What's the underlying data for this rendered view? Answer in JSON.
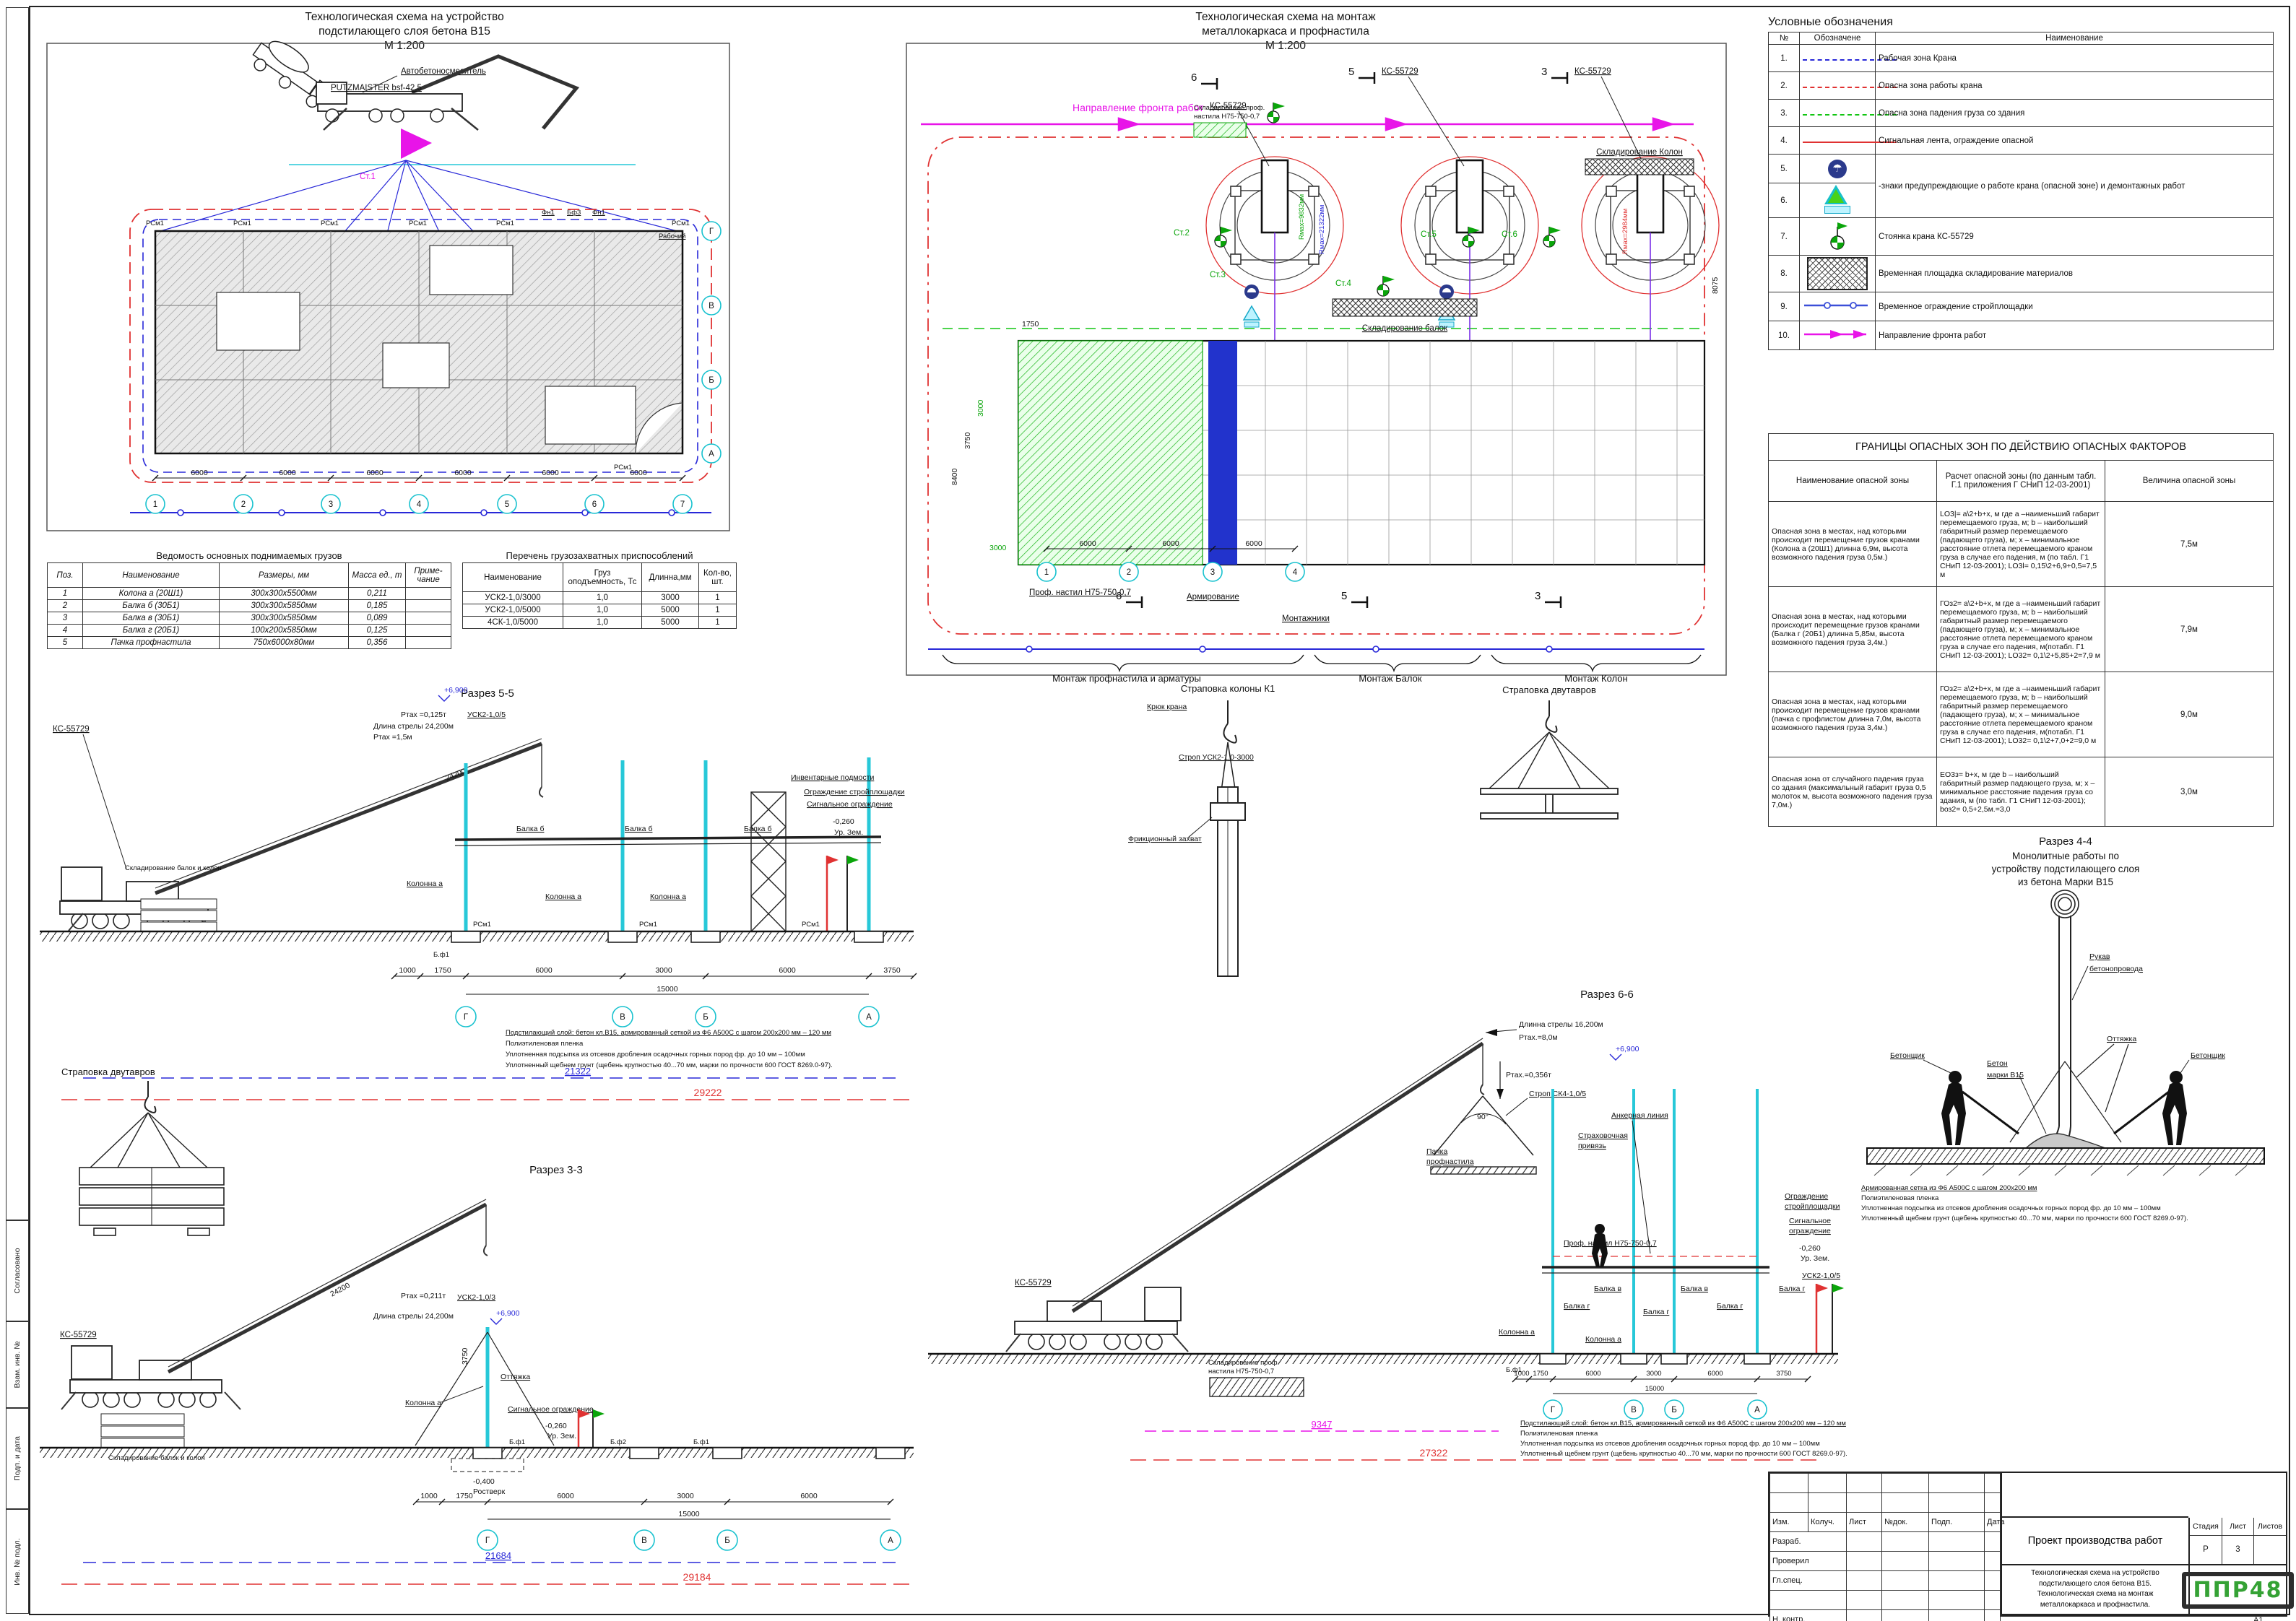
{
  "titles": {
    "plan1_l1": "Технологическая схема на устройство",
    "plan1_l2": "подстилающего слоя бетона В15",
    "plan1_scale": "М 1:200",
    "plan2_l1": "Технологическая схема на монтаж",
    "plan2_l2": "металлокаркаса и профнастила",
    "plan2_scale": "М 1:200"
  },
  "frame": {
    "fields": [
      "Согласовано",
      "Взам. инв. №",
      "Подп. и дата",
      "Инв. № подл."
    ],
    "format": "А1"
  },
  "legend": {
    "title": "Условные обозначения",
    "h_num": "№",
    "h_sym": "Обозначене",
    "h_name": "Наименование",
    "rows": [
      {
        "n": "1.",
        "name": "Рабочая зона Крана"
      },
      {
        "n": "2.",
        "name": "Опасна зона работы крана"
      },
      {
        "n": "3.",
        "name": "Опасна зона падения груза со здания"
      },
      {
        "n": "4.",
        "name": "Сигнальная лента, ограждение опасной"
      },
      {
        "n": "5.",
        "name": ""
      },
      {
        "n": "6.",
        "name": "-знаки предупреждающие о работе крана (опасной зоне) и демонтажных работ"
      },
      {
        "n": "7.",
        "name": "Стоянка крана КС-55729"
      },
      {
        "n": "8.",
        "name": "Временная площадка складирование материалов"
      },
      {
        "n": "9.",
        "name": "Временное ограждение стройплощадки"
      },
      {
        "n": "10.",
        "name": "Направление фронта работ"
      }
    ]
  },
  "danger": {
    "title": "ГРАНИЦЫ ОПАСНЫХ ЗОН ПО ДЕЙСТВИЮ ОПАСНЫХ ФАКТОРОВ",
    "h1": "Наименование опасной зоны",
    "h2": "Расчет опасной зоны (по данным табл. Г.1 приложения Г СНиП 12-03-2001)",
    "h3": "Величина опасной зоны",
    "rows": [
      {
        "name": "Опасная зона в местах, над которыми происходит перемещение грузов кранами (Колона а (20Ш1) длинна 6,9м, высота возможного падения груза 0,5м.)",
        "calc": "LO3|= a\\2+b+x, м  где а –наименьший габарит перемещаемого груза, м; b – наибольший габаритный размер перемещаемого (падающего груза), м; x – минимальное расстояние отлета перемещаемого краном груза в случае его падения, м (по табл. Г1 СНиП 12-03-2001); LO3l= 0,15\\2+6,9+0,5=7,5 м",
        "val": "7,5м"
      },
      {
        "name": "Опасная зона в местах, над которыми происходит перемещение грузов кранами (Балка г (20Б1) длинна 5,85м, высота возможного падения груза 3,4м.)",
        "calc": "ГОз2= a\\2+b+x, м  где а –наименьший габарит перемещаемого груза, м; b – наибольший габаритный размер перемещаемого (падающего груза), м; x – минимальное расстояние отлета перемещаемого краном груза в случае его падения, м(потабл. Г1 СНиП 12-03-2001); LO32= 0,1\\2+5,85+2=7,9 м",
        "val": "7,9м"
      },
      {
        "name": "Опасная зона в местах, над которыми происходит перемещение грузов кранами (пачка с профлистом длинна 7,0м, высота возможного падения груза 3,4м.)",
        "calc": "ГОз2= a\\2+b+x, м  где а –наименьший габарит перемещаемого груза, м; b – наибольший габаритный размер перемещаемого (падающего груза), м; x – минимальное расстояние отлета перемещаемого краном груза в случае его падения, м(потабл. Г1 СНиП 12-03-2001); LO32= 0,1\\2+7,0+2=9,0 м",
        "val": "9,0м"
      },
      {
        "name": "Опасная зона от случайного падения груза со здания (максимальный габарит груза 0,5 молоток м, высота возможного падения груза 7,0м.)",
        "calc": "EO3з= b+x, м  где b – наибольший габаритный размер падающего груза, м; x – минимальное расстояние падения груза со здания, м (по табл. Г1 СНиП 12-03-2001); bоз2= 0,5+2,5м.=3,0",
        "val": "3,0м"
      }
    ]
  },
  "loads": {
    "title": "Ведомость основных поднимаемых грузов",
    "headers": [
      "Поз.",
      "Наименование",
      "Размеры, мм",
      "Масса ед., т",
      "Приме- чание"
    ],
    "rows": [
      [
        "1",
        "Колона а (20Ш1)",
        "300х300х5500мм",
        "0,211",
        ""
      ],
      [
        "2",
        "Балка б (30Б1)",
        "300х300х5850мм",
        "0,185",
        ""
      ],
      [
        "3",
        "Балка в (30Б1)",
        "300х300х5850мм",
        "0,089",
        ""
      ],
      [
        "4",
        "Балка г (20Б1)",
        "100х200х5850мм",
        "0,125",
        ""
      ],
      [
        "5",
        "Пачка профнастила",
        "750х6000х80мм",
        "0,356",
        ""
      ]
    ]
  },
  "slings": {
    "title": "Перечень грузозахватных приспособлений",
    "headers": [
      "Наименование",
      "Груз оподъемность, Тс",
      "Длинна,мм",
      "Кол-во, шт."
    ],
    "rows": [
      [
        "УСК2-1,0/3000",
        "1,0",
        "3000",
        "1"
      ],
      [
        "УСК2-1,0/5000",
        "1,0",
        "5000",
        "1"
      ],
      [
        "4СК-1,0/5000",
        "1,0",
        "5000",
        "1"
      ]
    ]
  },
  "plan1": {
    "mixer": "Автобетоносмеситель",
    "pump": "PUTZMAISTER bsf-42,5",
    "stand": "Ст.1",
    "worker": "Рабочий",
    "rcm": "РСм1",
    "fn1": "Фн1",
    "bf3": "Бф3",
    "dim": "6000",
    "axes_num": [
      "1",
      "2",
      "3",
      "4",
      "5",
      "6",
      "7"
    ],
    "axes_let": [
      "Г",
      "В",
      "Б",
      "А"
    ]
  },
  "plan2": {
    "direction": "Направление фронта работ",
    "crane": "КС-55729",
    "stands": [
      "Ст.1",
      "Ст.2",
      "Ст.3",
      "Ст.4",
      "Ст.5",
      "Ст.6"
    ],
    "skl_prof1": "Складирование проф.",
    "skl_prof2": "настила Н75-750-0,7",
    "skl_balok": "Складирование балок",
    "skl_kolon": "Складирование Колон",
    "prof_nastil": "Проф. настил Н75-750-0,7",
    "armir": "Армирование",
    "mont": "Монтажники",
    "brace1": "Монтаж профнастила и арматуры",
    "brace2": "Монтаж Балок",
    "brace3": "Монтаж Колон",
    "r_green": "Rмах=9832мм",
    "r_blue": "Rмах=21322мм",
    "r_red": "Rмах=2984мм",
    "d6000": "6000",
    "d3000": "3000",
    "d3750": "3750",
    "d1750": "1750",
    "d8075": "8075",
    "d8400": "8400",
    "m6": "6",
    "m5": "5",
    "m3": "3",
    "axes_num": [
      "1",
      "2",
      "3",
      "4"
    ]
  },
  "notes": {
    "n1": "Подстилающий слой: бетон кл.В15, армированный сеткой из Ф6 А500С с шагом 200х200 мм – 120 мм",
    "n2": "Полиэтиленовая пленка",
    "n3": "Уплотненная подсыпка из отсевов дробления осадочных горных пород фр. до 10 мм – 100мм",
    "n4": "Уплотненный щебнем грунт (щебень крупностью 40...70 мм, марки по прочности 600 ГОСТ 8269.0-97)."
  },
  "notes44": {
    "n1": "Армированная сетка из Ф6 А500С с шагом 200х200 мм",
    "n2": "Полиэтиленовая пленка",
    "n3": "Уплотненная подсыпка из отсевов дробления осадочных горных пород фр. до 10 мм – 100мм",
    "n4": "Уплотненный щебнем грунт (щебень крупностью 40...70 мм, марки по прочности 600 ГОСТ 8269.0-97)."
  },
  "sec55": {
    "title": "Разрез 5-5",
    "dim24200": "24200",
    "elev": "+6,900",
    "pmax": "Ртах =0,125т",
    "boomlen": "Длина стрелы 24,200м",
    "pmax2": "Ртах =1,5м",
    "usk": "УСК2-1,0/5",
    "balka": "Балка б",
    "col": "Колонна а",
    "podm": "Инвентарные подмости",
    "ogr1": "Ограждение стройплощадки",
    "ogr2": "Сигнальное ограждение",
    "lvl": "-0,260",
    "ur": "Ур. Зем.",
    "crane": "КС-55729",
    "skl": "Складирование балок и колон",
    "bf1": "Б.ф1",
    "rcm": "РСм1",
    "d1000": "1000",
    "d1750": "1750",
    "d6000": "6000",
    "d3000": "3000",
    "d3750": "3750",
    "d15000": "15000",
    "dimb": "21322",
    "dimr": "29222",
    "axes": [
      "Г",
      "В",
      "Б",
      "А"
    ]
  },
  "strop_k1": {
    "title": "Страповка колоны К1",
    "kruk": "Крюк крана",
    "strop": "Строп УСК2-1,0-3000",
    "frik": "Фрикционный захват"
  },
  "strop_dvut": {
    "title": "Страповка двутавров"
  },
  "sec66": {
    "title": "Разрез 6-6",
    "boomlen": "Длинна стрелы 16,200м",
    "pmax8": "Ртах.=8,0м",
    "pmax356": "Ртах.=0,356т",
    "strop": "Строп СК4-1,0/5",
    "anker": "Анкерная линия",
    "priv1": "Страховочная",
    "priv2": "привязь",
    "pachka1": "Пачка",
    "pachka2": "профнастила",
    "angle": "90°",
    "elev": "+6,900",
    "prof": "Проф. настил Н75-750-0,7",
    "usk": "УСК2-1,0/5",
    "balka_v": "Балка в",
    "balka_g": "Балка г",
    "col": "Колонна а",
    "crane": "КС-55729",
    "skl1": "Складирование проф.",
    "skl2": "настила Н75-750-0,7",
    "ogr1": "Ограждение",
    "ogr1b": "стройплощадки",
    "ogr2": "Сигнальное",
    "ogr2b": "ограждение",
    "lvl": "-0,260",
    "ur": "Ур. Зем.",
    "bf1": "Б.ф1",
    "d1000": "1000",
    "d1750": "1750",
    "d6000": "6000",
    "d3000": "3000",
    "d3750": "3750",
    "d15000": "15000",
    "dimm": "9347",
    "dimr": "27322",
    "axes": [
      "Г",
      "В",
      "Б",
      "А"
    ]
  },
  "sec44": {
    "t1": "Разрез 4-4",
    "t2": "Монолитные работы по",
    "t3": "устройству подстилающего слоя",
    "t4": "из бетона Марки В15",
    "rukav1": "Рукав",
    "rukav2": "бетонопровода",
    "ott": "Оттяжка",
    "bet": "Бетонщик",
    "beton1": "Бетон",
    "beton2": "марки В15"
  },
  "sec33": {
    "title": "Разрез 3-3",
    "dim24200": "24200",
    "pmax": "Ртах =0,211т",
    "usk": "УСК2-1,0/3",
    "boomlen": "Длина стрелы 24,200м",
    "elev": "+6,900",
    "ott": "Оттяжка",
    "d3750v": "3750",
    "col": "Колонна а",
    "sig": "Сигнальное ограждение",
    "lvl": "-0,260",
    "ur": "Ур. Зем.",
    "lvl2": "-0,400",
    "rost": "Ростверк",
    "crane": "КС-55729",
    "skl": "Складирование балок и колон",
    "bf1": "Б.ф1",
    "bf2": "Б.ф2",
    "d1000": "1000",
    "d1750": "1750",
    "d6000": "6000",
    "d3000": "3000",
    "d15000": "15000",
    "dimb": "21684",
    "dimr": "29184",
    "axes": [
      "Г",
      "В",
      "Б",
      "А"
    ]
  },
  "tb": {
    "c_izm": "Изм.",
    "c_koluch": "Колуч.",
    "c_list": "Лист",
    "c_ndok": "№док.",
    "c_podp": "Подп.",
    "c_data": "Дата",
    "r1": "Разраб.",
    "r2": "Проверил",
    "r3": "Гл.спец.",
    "r6": "Н. контр.",
    "project": "Проект производства работ",
    "d1": "Технологическая схема на устройство",
    "d2": "подстилающего слоя бетона В15.",
    "d3": "Технологическая схема на монтаж",
    "d4": "металлокаркаса и профнастила.",
    "stage_h": "Стадия",
    "list_h": "Лист",
    "listov_h": "Листов",
    "stage": "Р",
    "list": "3",
    "logo": "ППР48"
  }
}
